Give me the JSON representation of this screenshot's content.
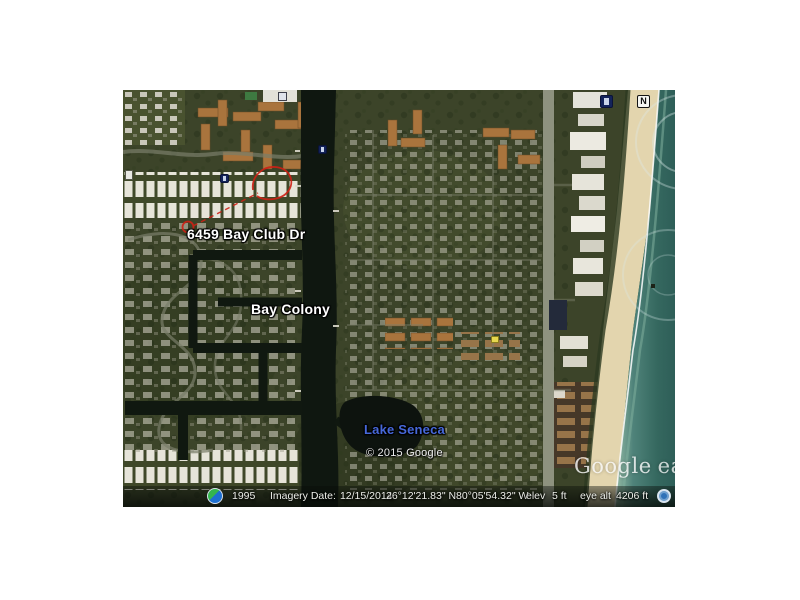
{
  "map_labels": {
    "address": "6459 Bay Club Dr",
    "neighborhood": "Bay Colony",
    "lake": "Lake Seneca",
    "copyright": "© 2015 Google",
    "watermark_google": "Google",
    "watermark_earth": "earth",
    "north_badge": "N"
  },
  "status_bar": {
    "timeline_year": "1995",
    "imagery_date_label": "Imagery Date:",
    "imagery_date": "12/15/2014",
    "latitude": "26°12'21.83\" N",
    "longitude": "80°05'54.32\" W",
    "elevation_label": "elev",
    "elevation": "5 ft",
    "eye_alt_label": "eye alt",
    "eye_alt": "4206 ft"
  },
  "colors": {
    "annotation_red": "#cf2015",
    "water_label_blue": "#4668d9",
    "ocean_teal": "#35685f",
    "beach_sand": "#e3d5ae",
    "vegetation": "#39422a"
  }
}
